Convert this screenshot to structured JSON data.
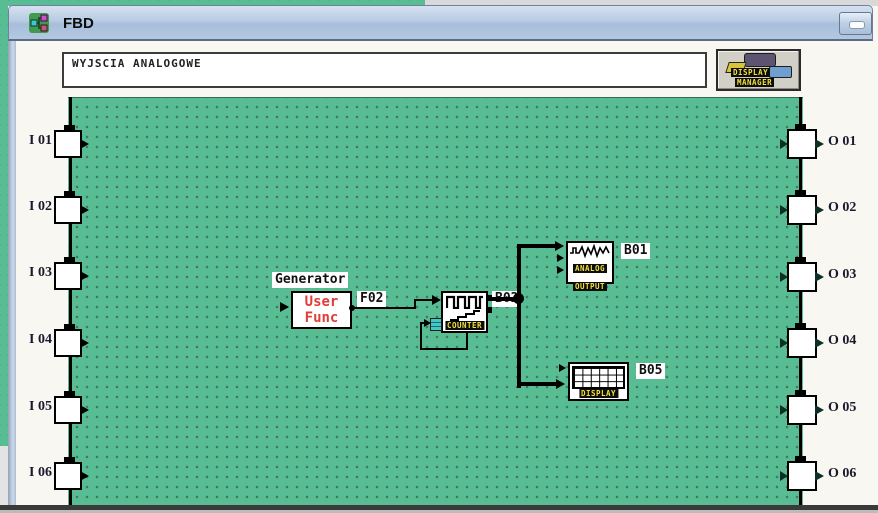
{
  "window": {
    "title": "FBD"
  },
  "header": {
    "comment_field": {
      "value": "WYJSCIA ANALOGOWE"
    },
    "display_manager": {
      "line1": "DISPLAY",
      "line2": "MANAGER"
    }
  },
  "io": {
    "inputs": [
      "I 01",
      "I 02",
      "I 03",
      "I 04",
      "I 05",
      "I 06"
    ],
    "outputs": [
      "O 01",
      "O 02",
      "O 03",
      "O 04",
      "O 05",
      "O 06"
    ]
  },
  "blocks": {
    "generator": {
      "caption": "Generator",
      "line1": "User",
      "line2": "Func",
      "wire_label": "F02"
    },
    "counter": {
      "name": "COUNTER",
      "wire_label": "B02"
    },
    "analog_output": {
      "line1": "ANALOG",
      "line2": "OUTPUT",
      "ref": "B01"
    },
    "display": {
      "name": "DISPLAY",
      "ref": "B05"
    }
  },
  "colors": {
    "canvas_green": "#58bd93",
    "accent_red": "#e03c38",
    "label_yellow": "#f2e23a"
  }
}
